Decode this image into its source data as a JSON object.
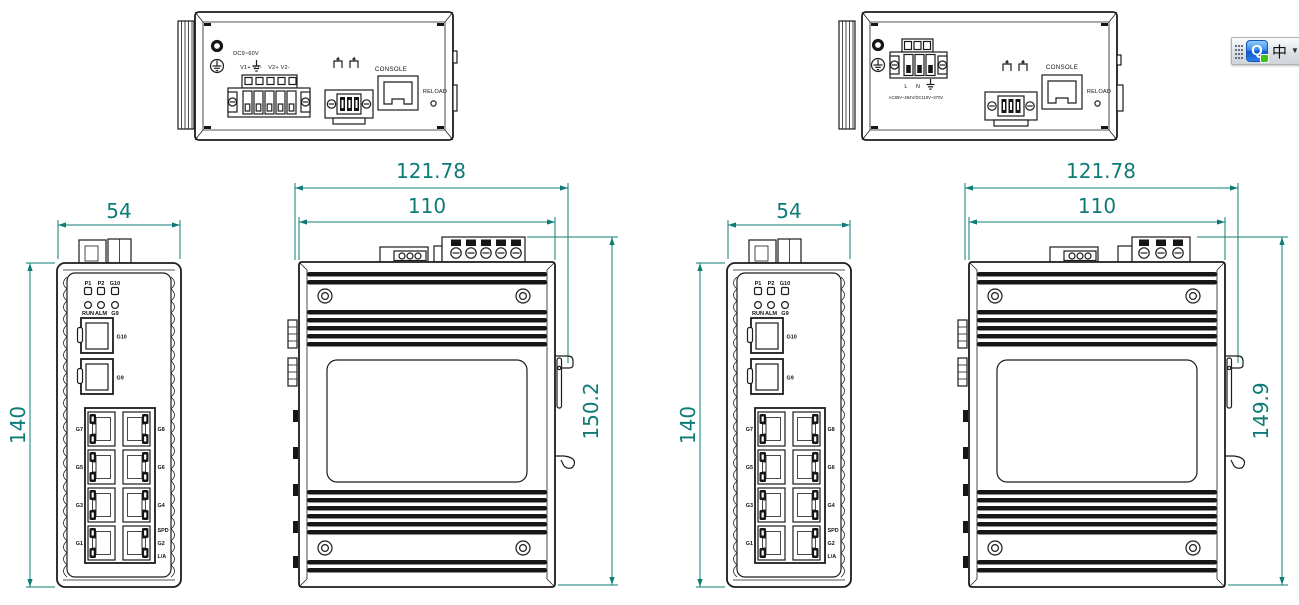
{
  "colors": {
    "dimension_teal": "#0e7c76",
    "line_art": "#1c1c1c",
    "ime_blue": "#2f7de8",
    "ime_green": "#3ec215"
  },
  "top_view_dc": {
    "power": "DC9~60V",
    "terminals_left": "V1+ V1-",
    "terminals_right": "V2+ V2-",
    "console": "CONSOLE",
    "reload": "RELOAD"
  },
  "top_view_ac": {
    "line": "L",
    "neutral": "N",
    "power": "AC85V~264V/DC110V~370V",
    "console": "CONSOLE",
    "reload": "RELOAD"
  },
  "front_view": {
    "dim_width": "54",
    "dim_height": "140",
    "leds_top": [
      "P1",
      "P2",
      "G10"
    ],
    "leds_bottom": [
      "RUN",
      "ALM",
      "G9"
    ],
    "sfp": [
      "G10",
      "G9"
    ],
    "ports_left": [
      "G7",
      "G5",
      "G3",
      "G1"
    ],
    "ports_right": [
      "G8",
      "G6",
      "G4"
    ],
    "port_spd": "SPD",
    "port_g2": "G2",
    "port_la": "L/A"
  },
  "side_view_dc": {
    "dim_outer": "121.78",
    "dim_inner": "110",
    "dim_height": "150.2"
  },
  "side_view_ac": {
    "dim_outer": "121.78",
    "dim_inner": "110",
    "dim_height": "149.9"
  },
  "ime": {
    "q": "Q",
    "lang": "中",
    "caret": "▼"
  }
}
